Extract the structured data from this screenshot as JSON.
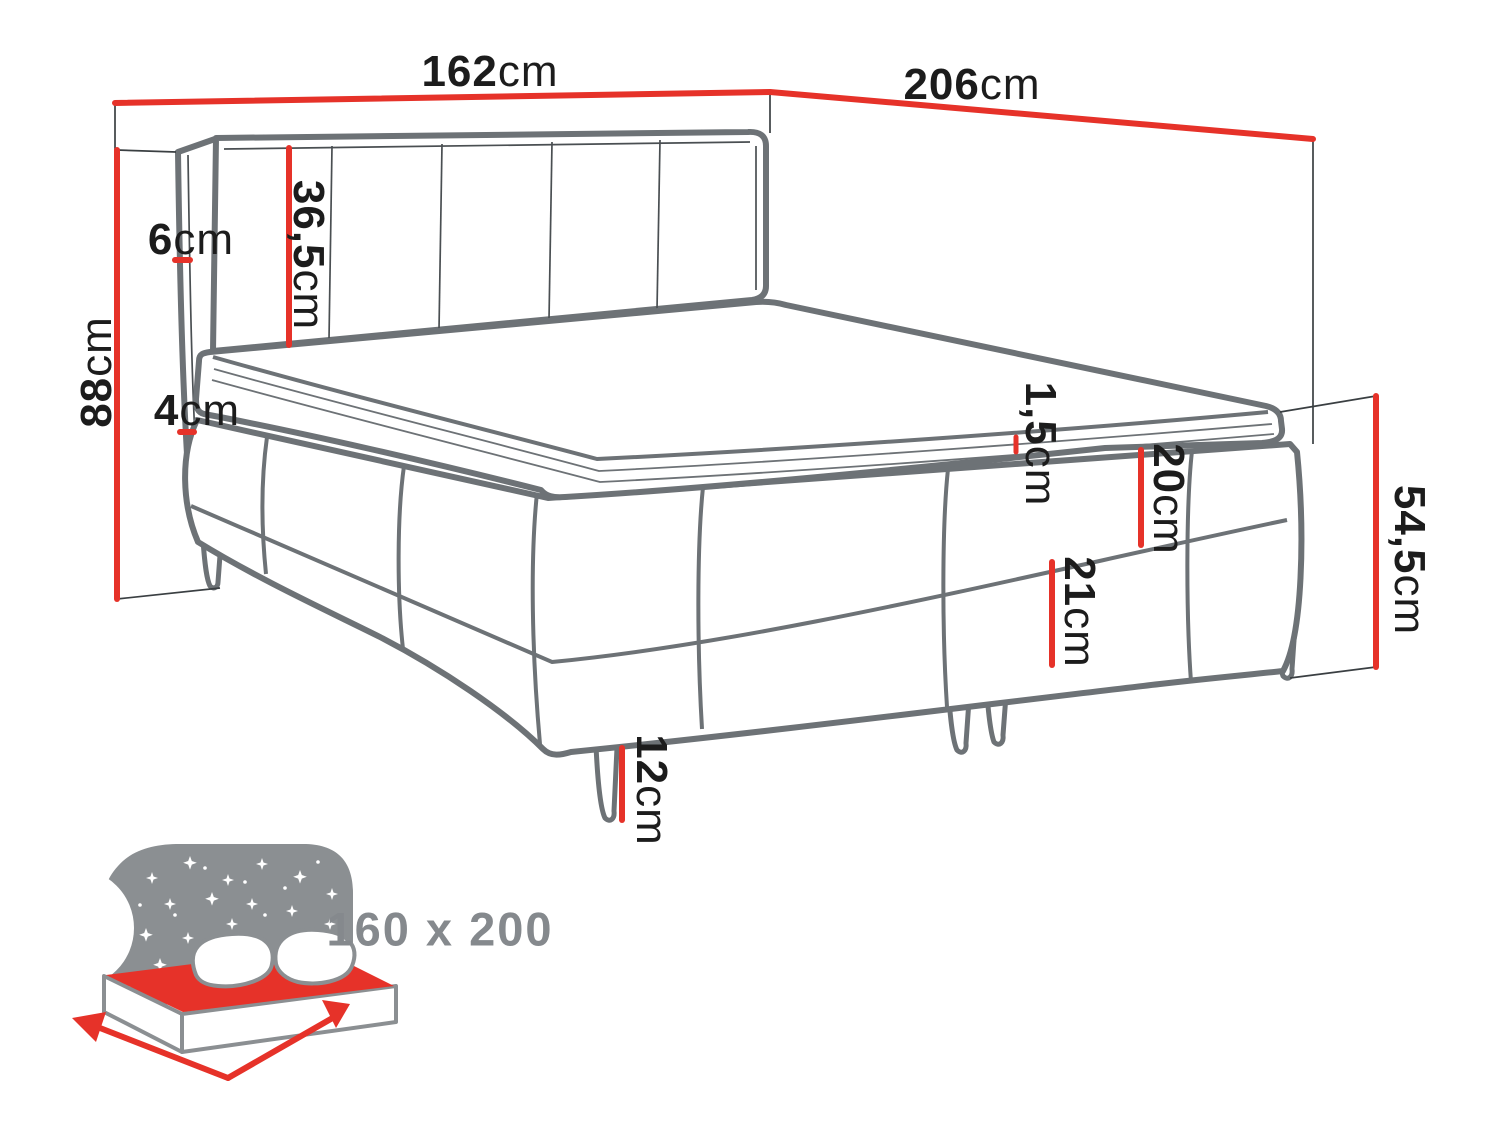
{
  "diagram": {
    "title_note": "bed dimension diagram",
    "labels": {
      "width": {
        "value": "162",
        "unit": "cm"
      },
      "length": {
        "value": "206",
        "unit": "cm"
      },
      "total_height": {
        "value": "88",
        "unit": "cm"
      },
      "headboard_panel": {
        "value": "36,5",
        "unit": "cm"
      },
      "frame_top": {
        "value": "6",
        "unit": "cm"
      },
      "frame_gap": {
        "value": "4",
        "unit": "cm"
      },
      "topper": {
        "value": "1,5",
        "unit": "cm"
      },
      "mattress": {
        "value": "20",
        "unit": "cm"
      },
      "base": {
        "value": "21",
        "unit": "cm"
      },
      "side_height": {
        "value": "54,5",
        "unit": "cm"
      },
      "leg": {
        "value": "12",
        "unit": "cm"
      }
    },
    "size_badge": "160 x 200",
    "icons": {
      "size_icon": "bed-with-starry-headboard-icon"
    },
    "colors": {
      "dimension_red": "#e63229",
      "drawing_gray": "#6d7276",
      "thin_line": "#3a3f42",
      "icon_gray": "#8b8f92",
      "label_black": "#1c1c1c",
      "size_text_gray": "#85898d",
      "background": "#ffffff"
    }
  }
}
